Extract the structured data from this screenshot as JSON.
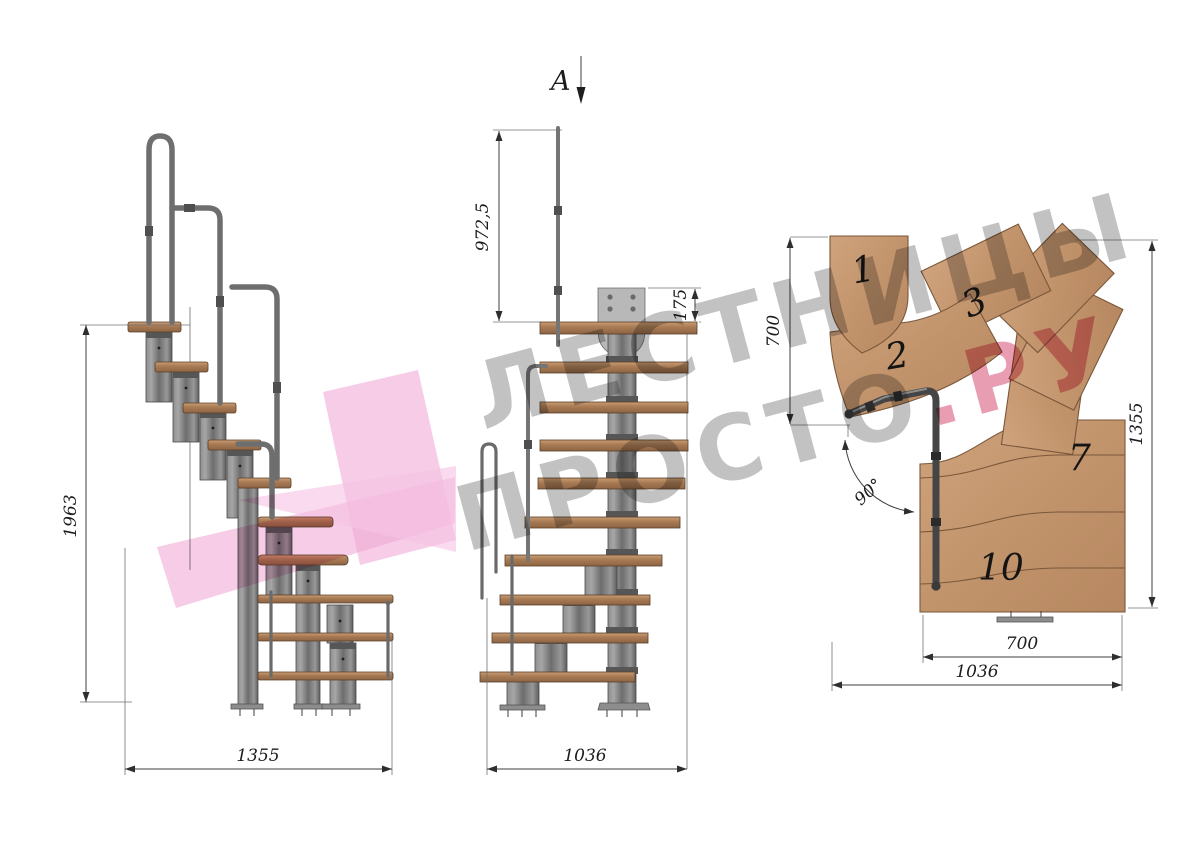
{
  "views": {
    "side": {
      "label": "side-elevation",
      "dim_height": "1963",
      "dim_width": "1355"
    },
    "front": {
      "label": "front-elevation",
      "section_label": "A",
      "dim_rail_height": "972,5",
      "dim_plate_height": "175",
      "dim_width": "1036"
    },
    "plan": {
      "label": "plan-view",
      "tread_labels": [
        "1",
        "2",
        "3",
        "7",
        "10"
      ],
      "dim_left": "700",
      "dim_right": "1355",
      "dim_bottom_inner": "700",
      "dim_bottom_outer": "1036",
      "dim_angle": "90°"
    }
  },
  "watermark": {
    "line1": "ЛЕСТНИЦЫ",
    "line2_gray": "ПРОСТО",
    "line2_pink": ".РУ"
  },
  "colors": {
    "logo_pink": "#eeb0d7",
    "watermark_gray": "#8c8c8c",
    "watermark_pink": "#d54d74",
    "wood": "#b98a63",
    "metal": "#7a7a7a"
  }
}
